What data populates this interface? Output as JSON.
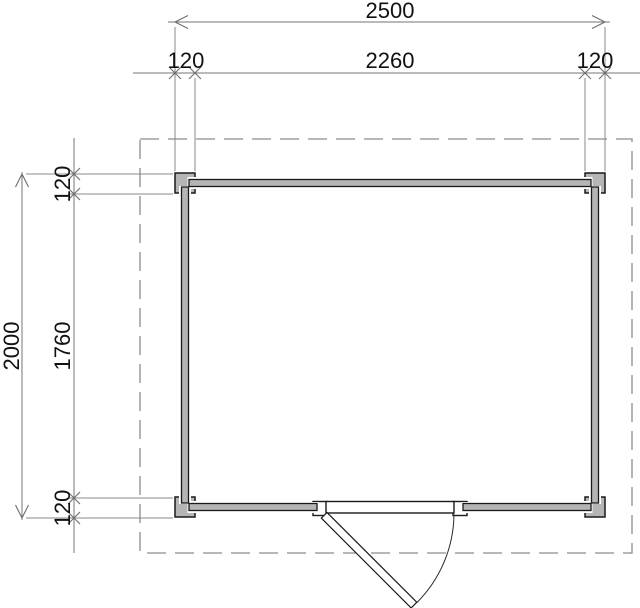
{
  "drawing": {
    "type": "floor-plan",
    "units": "mm",
    "colors": {
      "background": "#ffffff",
      "wall_fill": "#b5b5b5",
      "outline": "#1a1a1a",
      "dim_line": "#757575",
      "roof_dash": "#8c8c8c"
    },
    "dims": {
      "top_overall": "2500",
      "top_left": "120",
      "top_inner": "2260",
      "top_right": "120",
      "side_overall": "2000",
      "side_top": "120",
      "side_inner": "1760",
      "side_bottom": "120"
    }
  }
}
